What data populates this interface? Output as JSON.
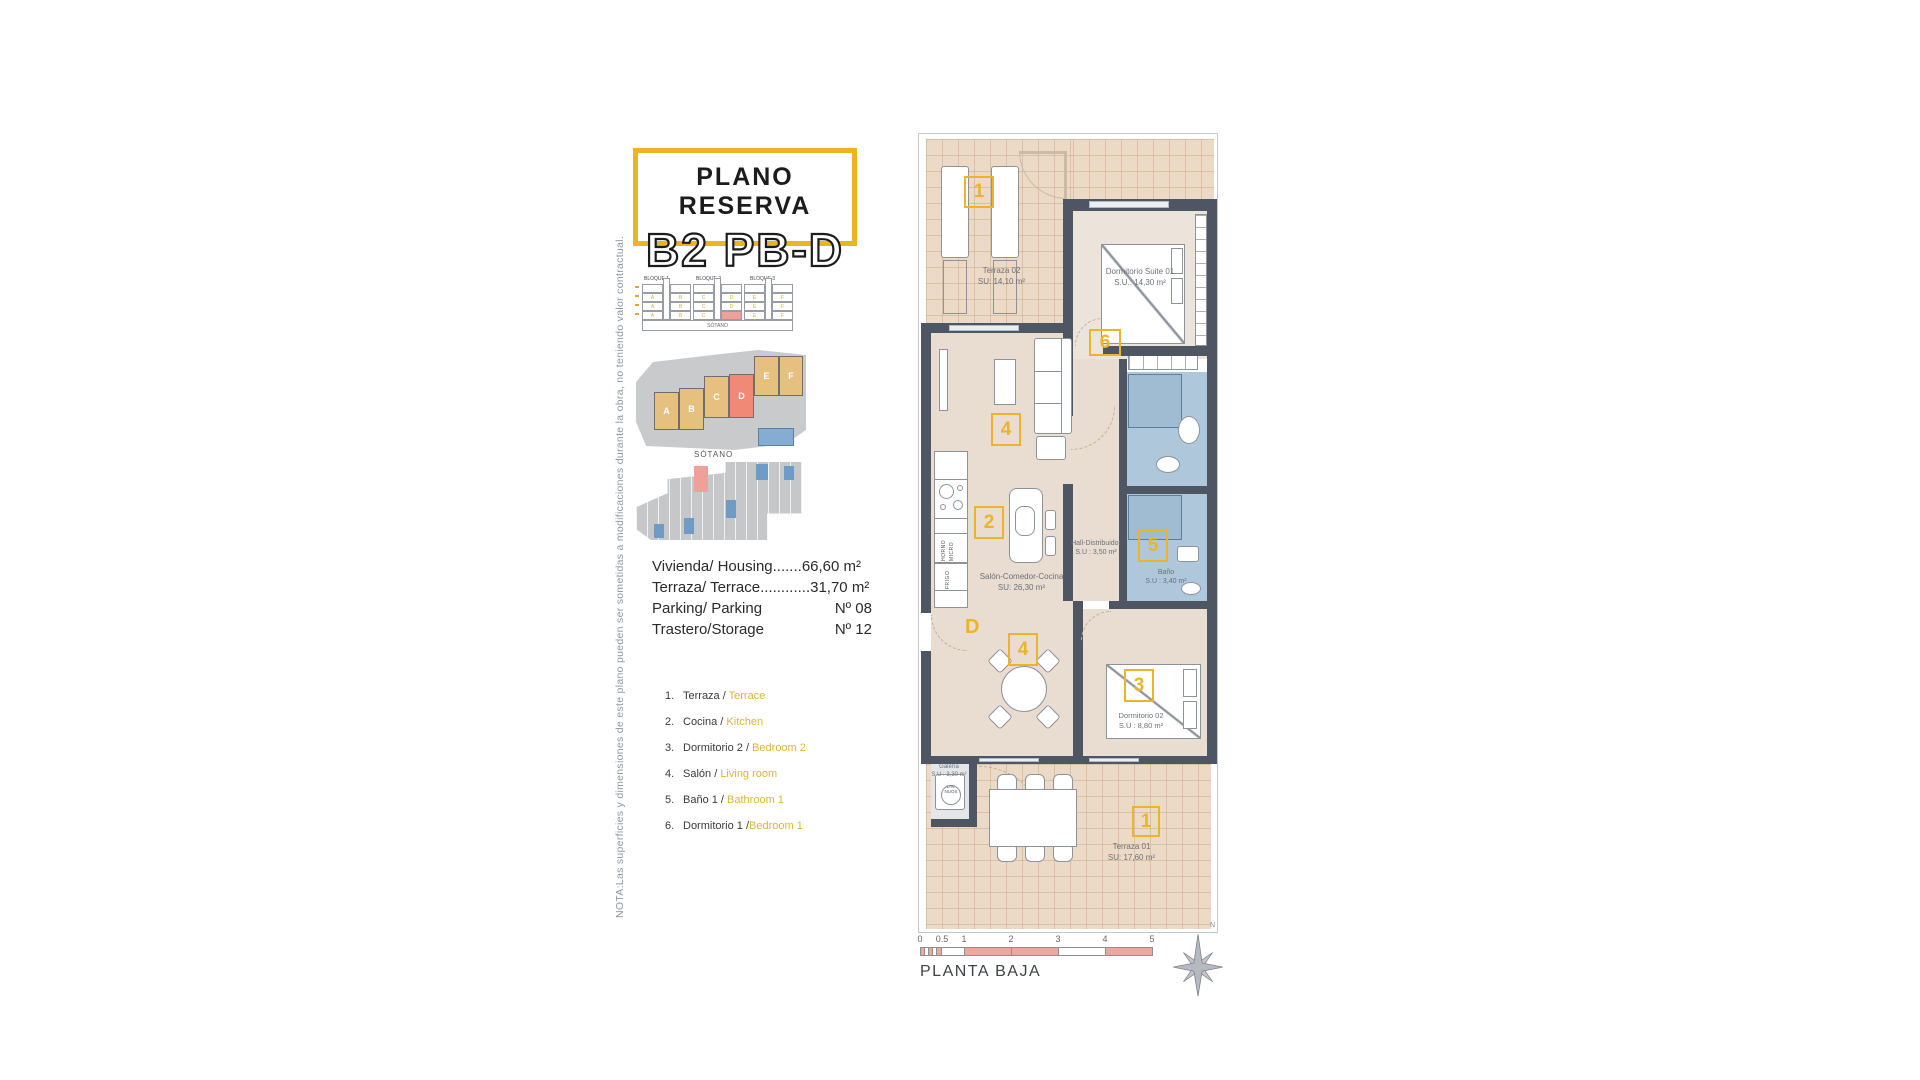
{
  "note_vertical": "NOTA:Las superficies y dimensiones de este plano pueden ser sometidas a modificaciones durante la obra, no teniendo valor contractual.",
  "title": {
    "line1": "PLANO RESERVA",
    "line2": "B2 PB-D"
  },
  "elevation": {
    "blocks": [
      "BLOQUE 1",
      "BLOQUE 2",
      "BLOQUE 3"
    ],
    "units": [
      "A",
      "B",
      "C",
      "D",
      "E",
      "F"
    ],
    "sotano": "SÓTANO",
    "highlight_unit": "D"
  },
  "site_plan": {
    "units": [
      "A",
      "B",
      "C",
      "D",
      "E",
      "F"
    ],
    "highlight_unit": "D"
  },
  "sotano_plan": {
    "label": "SÓTANO"
  },
  "info": {
    "rows": [
      {
        "label": "Vivienda/ Housing.......",
        "value": "66,60 m²"
      },
      {
        "label": "Terraza/ Terrace............",
        "value": "31,70 m²"
      },
      {
        "label": "Parking/ Parking",
        "value": "Nº 08"
      },
      {
        "label": "Trastero/Storage",
        "value": "Nº 12"
      }
    ]
  },
  "legend": {
    "items": [
      {
        "num": "1.",
        "es": "Terraza / ",
        "en": "Terrace"
      },
      {
        "num": "2.",
        "es": "Cocina / ",
        "en": "Kitchen"
      },
      {
        "num": "3.",
        "es": "Dormitorio 2 / ",
        "en": "Bedroom 2"
      },
      {
        "num": "4.",
        "es": "Salón / ",
        "en": "Living room"
      },
      {
        "num": "5.",
        "es": "Baño 1 / ",
        "en": "Bathroom 1"
      },
      {
        "num": "6.",
        "es": "Dormitorio 1 /",
        "en": "Bedroom 1"
      }
    ]
  },
  "plan": {
    "terraza02": {
      "name": "Terraza 02",
      "area": "SU: 14,10 m²"
    },
    "suite": {
      "name": "Dormitorio Suite 01",
      "area": "S.U.: 14,30 m²"
    },
    "salon": {
      "name": "Salón-Comedor-Cocina",
      "area": "SU: 26,30 m²"
    },
    "hall": {
      "name": "Hall-Distribuidor",
      "area": "S.U : 3,50 m²"
    },
    "bano": {
      "name": "Baño",
      "area": "S.U : 3,40 m²"
    },
    "dorm02": {
      "name": "Dormitorio 02",
      "area": "S.U : 8,80 m²"
    },
    "galeria": {
      "name": "Galería",
      "area": "S.U : 3,30 m²"
    },
    "terraza01": {
      "name": "Terraza 01",
      "area": "SU: 17,60 m²"
    },
    "markers": {
      "terraza02_top": "1",
      "dorm1": "6",
      "salon_tv": "4",
      "cocina": "2",
      "bano1": "5",
      "comedor": "4",
      "dorm2": "3",
      "terraza01_bottom": "1",
      "entrance_door": "D"
    },
    "kitchen": {
      "horno": "HORNO",
      "micro": "MICRO",
      "frigo": "FRIGO",
      "lav1": "LAV.",
      "lav2": "NUOS"
    }
  },
  "footer": {
    "ticks": [
      "0",
      "0.5",
      "1",
      "2",
      "3",
      "4",
      "5"
    ],
    "label": "PLANTA BAJA",
    "north": "N"
  },
  "colors": {
    "accent_yellow": "#edb329",
    "wall": "#4e5664",
    "terrace_tile": "#ecdac6",
    "bath_blue": "#aec7da",
    "scale_pink": "#e9a99c",
    "highlight_red": "#f0a096",
    "legend_gold": "#d9b53a"
  }
}
